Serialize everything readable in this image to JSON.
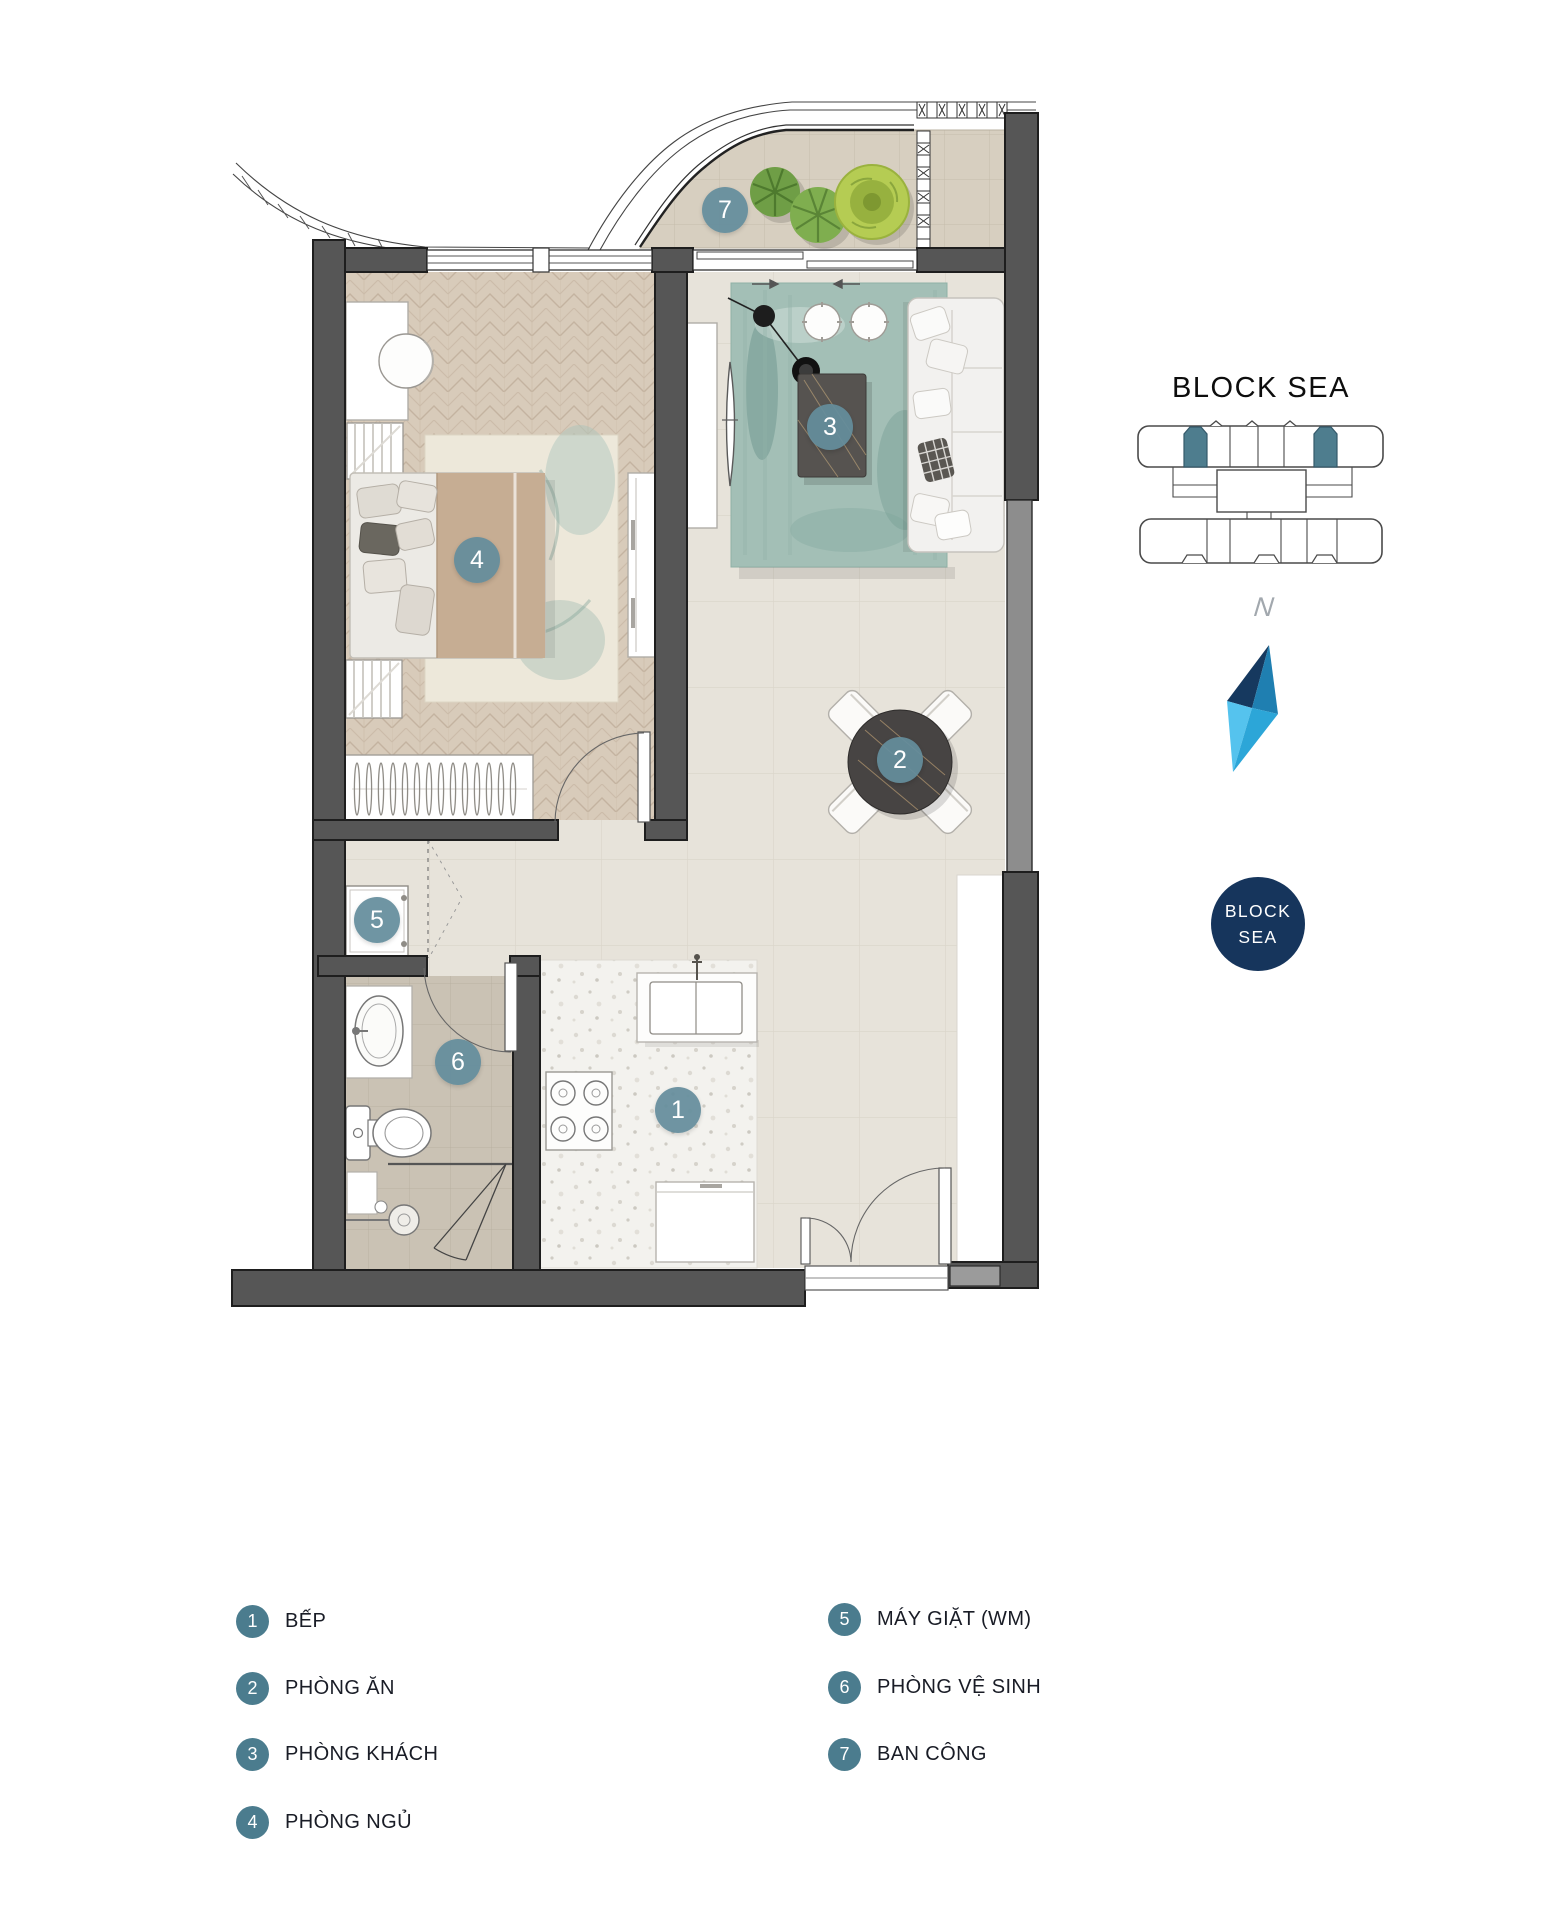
{
  "plan": {
    "badges": [
      {
        "num": "1",
        "label": "BẾP"
      },
      {
        "num": "2",
        "label": "PHÒNG ĂN"
      },
      {
        "num": "3",
        "label": "PHÒNG KHÁCH"
      },
      {
        "num": "4",
        "label": "PHÒNG NGỦ"
      },
      {
        "num": "5",
        "label": "MÁY GIẶT (WM)"
      },
      {
        "num": "6",
        "label": "PHÒNG VỆ SINH"
      },
      {
        "num": "7",
        "label": "BAN CÔNG"
      }
    ]
  },
  "block": {
    "title": "BLOCK SEA",
    "badge_line1": "BLOCK",
    "badge_line2": "SEA",
    "compass_label": "N"
  },
  "legend": {
    "left": [
      {
        "num": "1",
        "label": "BẾP"
      },
      {
        "num": "2",
        "label": "PHÒNG ĂN"
      },
      {
        "num": "3",
        "label": "PHÒNG KHÁCH"
      },
      {
        "num": "4",
        "label": "PHÒNG NGỦ"
      }
    ],
    "right": [
      {
        "num": "5",
        "label": "MÁY GIẶT (WM)"
      },
      {
        "num": "6",
        "label": "PHÒNG VỆ SINH"
      },
      {
        "num": "7",
        "label": "BAN CÔNG"
      }
    ]
  },
  "colors": {
    "badge_teal": "#4b7c8e",
    "navy": "#16355c",
    "wall_dark": "#565656",
    "compass": [
      "#16395f",
      "#1f7fb1",
      "#55c3ee",
      "#2ca6d8"
    ]
  }
}
